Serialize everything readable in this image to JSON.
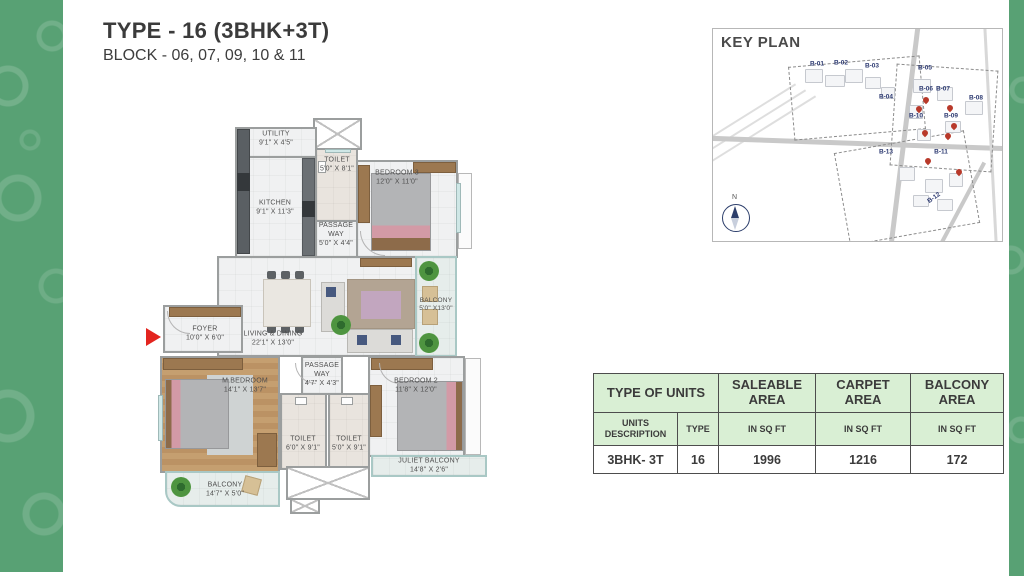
{
  "title": {
    "main": "TYPE - 16 (3BHK+3T)",
    "sub": "BLOCK - 06, 07, 09, 10 & 11"
  },
  "floorplan": {
    "rooms": [
      {
        "name": "UTILITY",
        "dims": "9'1\" X 4'5\""
      },
      {
        "name": "TOILET",
        "dims": "5'0\" X 8'1\""
      },
      {
        "name": "KITCHEN",
        "dims": "9'1\" X 11'3\""
      },
      {
        "name": "PASSAGE WAY",
        "dims": "5'0\" X 4'4\""
      },
      {
        "name": "BEDROOM 3",
        "dims": "12'0\" X 11'0\""
      },
      {
        "name": "BALCONY",
        "dims": "5'0\" X13'0\""
      },
      {
        "name": "FOYER",
        "dims": "10'0\" X 6'0\""
      },
      {
        "name": "LIVING & DINING",
        "dims": "22'1\" X 13'0\""
      },
      {
        "name": "M.BEDROOM",
        "dims": "14'1\" X 13'7\""
      },
      {
        "name": "PASSAGE WAY",
        "dims": "4'7\" X 4'3\""
      },
      {
        "name": "TOILET",
        "dims": "6'0\" X 9'1\""
      },
      {
        "name": "TOILET",
        "dims": "5'0\" X 9'1\""
      },
      {
        "name": "BEDROOM 2",
        "dims": "11'8\" X 12'0\""
      },
      {
        "name": "JULIET BALCONY",
        "dims": "14'8\" X 2'6\""
      },
      {
        "name": "BALCONY",
        "dims": "14'7\" X 5'0\""
      }
    ]
  },
  "keyplan": {
    "title": "KEY PLAN",
    "north": "N",
    "blocks": [
      "B-01",
      "B-02",
      "B-03",
      "B-04",
      "B-05",
      "B-06",
      "B-07",
      "B-08",
      "B-09",
      "B-10",
      "B-11",
      "B-12",
      "B-13"
    ]
  },
  "table": {
    "row1": [
      "TYPE OF UNITS",
      "SALEABLE AREA",
      "CARPET AREA",
      "BALCONY AREA"
    ],
    "row2": [
      "UNITS DESCRIPTION",
      "TYPE",
      "IN SQ FT",
      "IN SQ FT",
      "IN SQ FT"
    ],
    "row3": [
      "3BHK- 3T",
      "16",
      "1996",
      "1216",
      "172"
    ]
  },
  "colors": {
    "band_green": "#58a174",
    "entry_arrow_red": "#e3251f",
    "table_header_green": "#d9efd4",
    "keyplan_label_blue": "#2e3b72",
    "unit_marker_red": "#b8392a",
    "wood_floor": "#c59f70"
  }
}
